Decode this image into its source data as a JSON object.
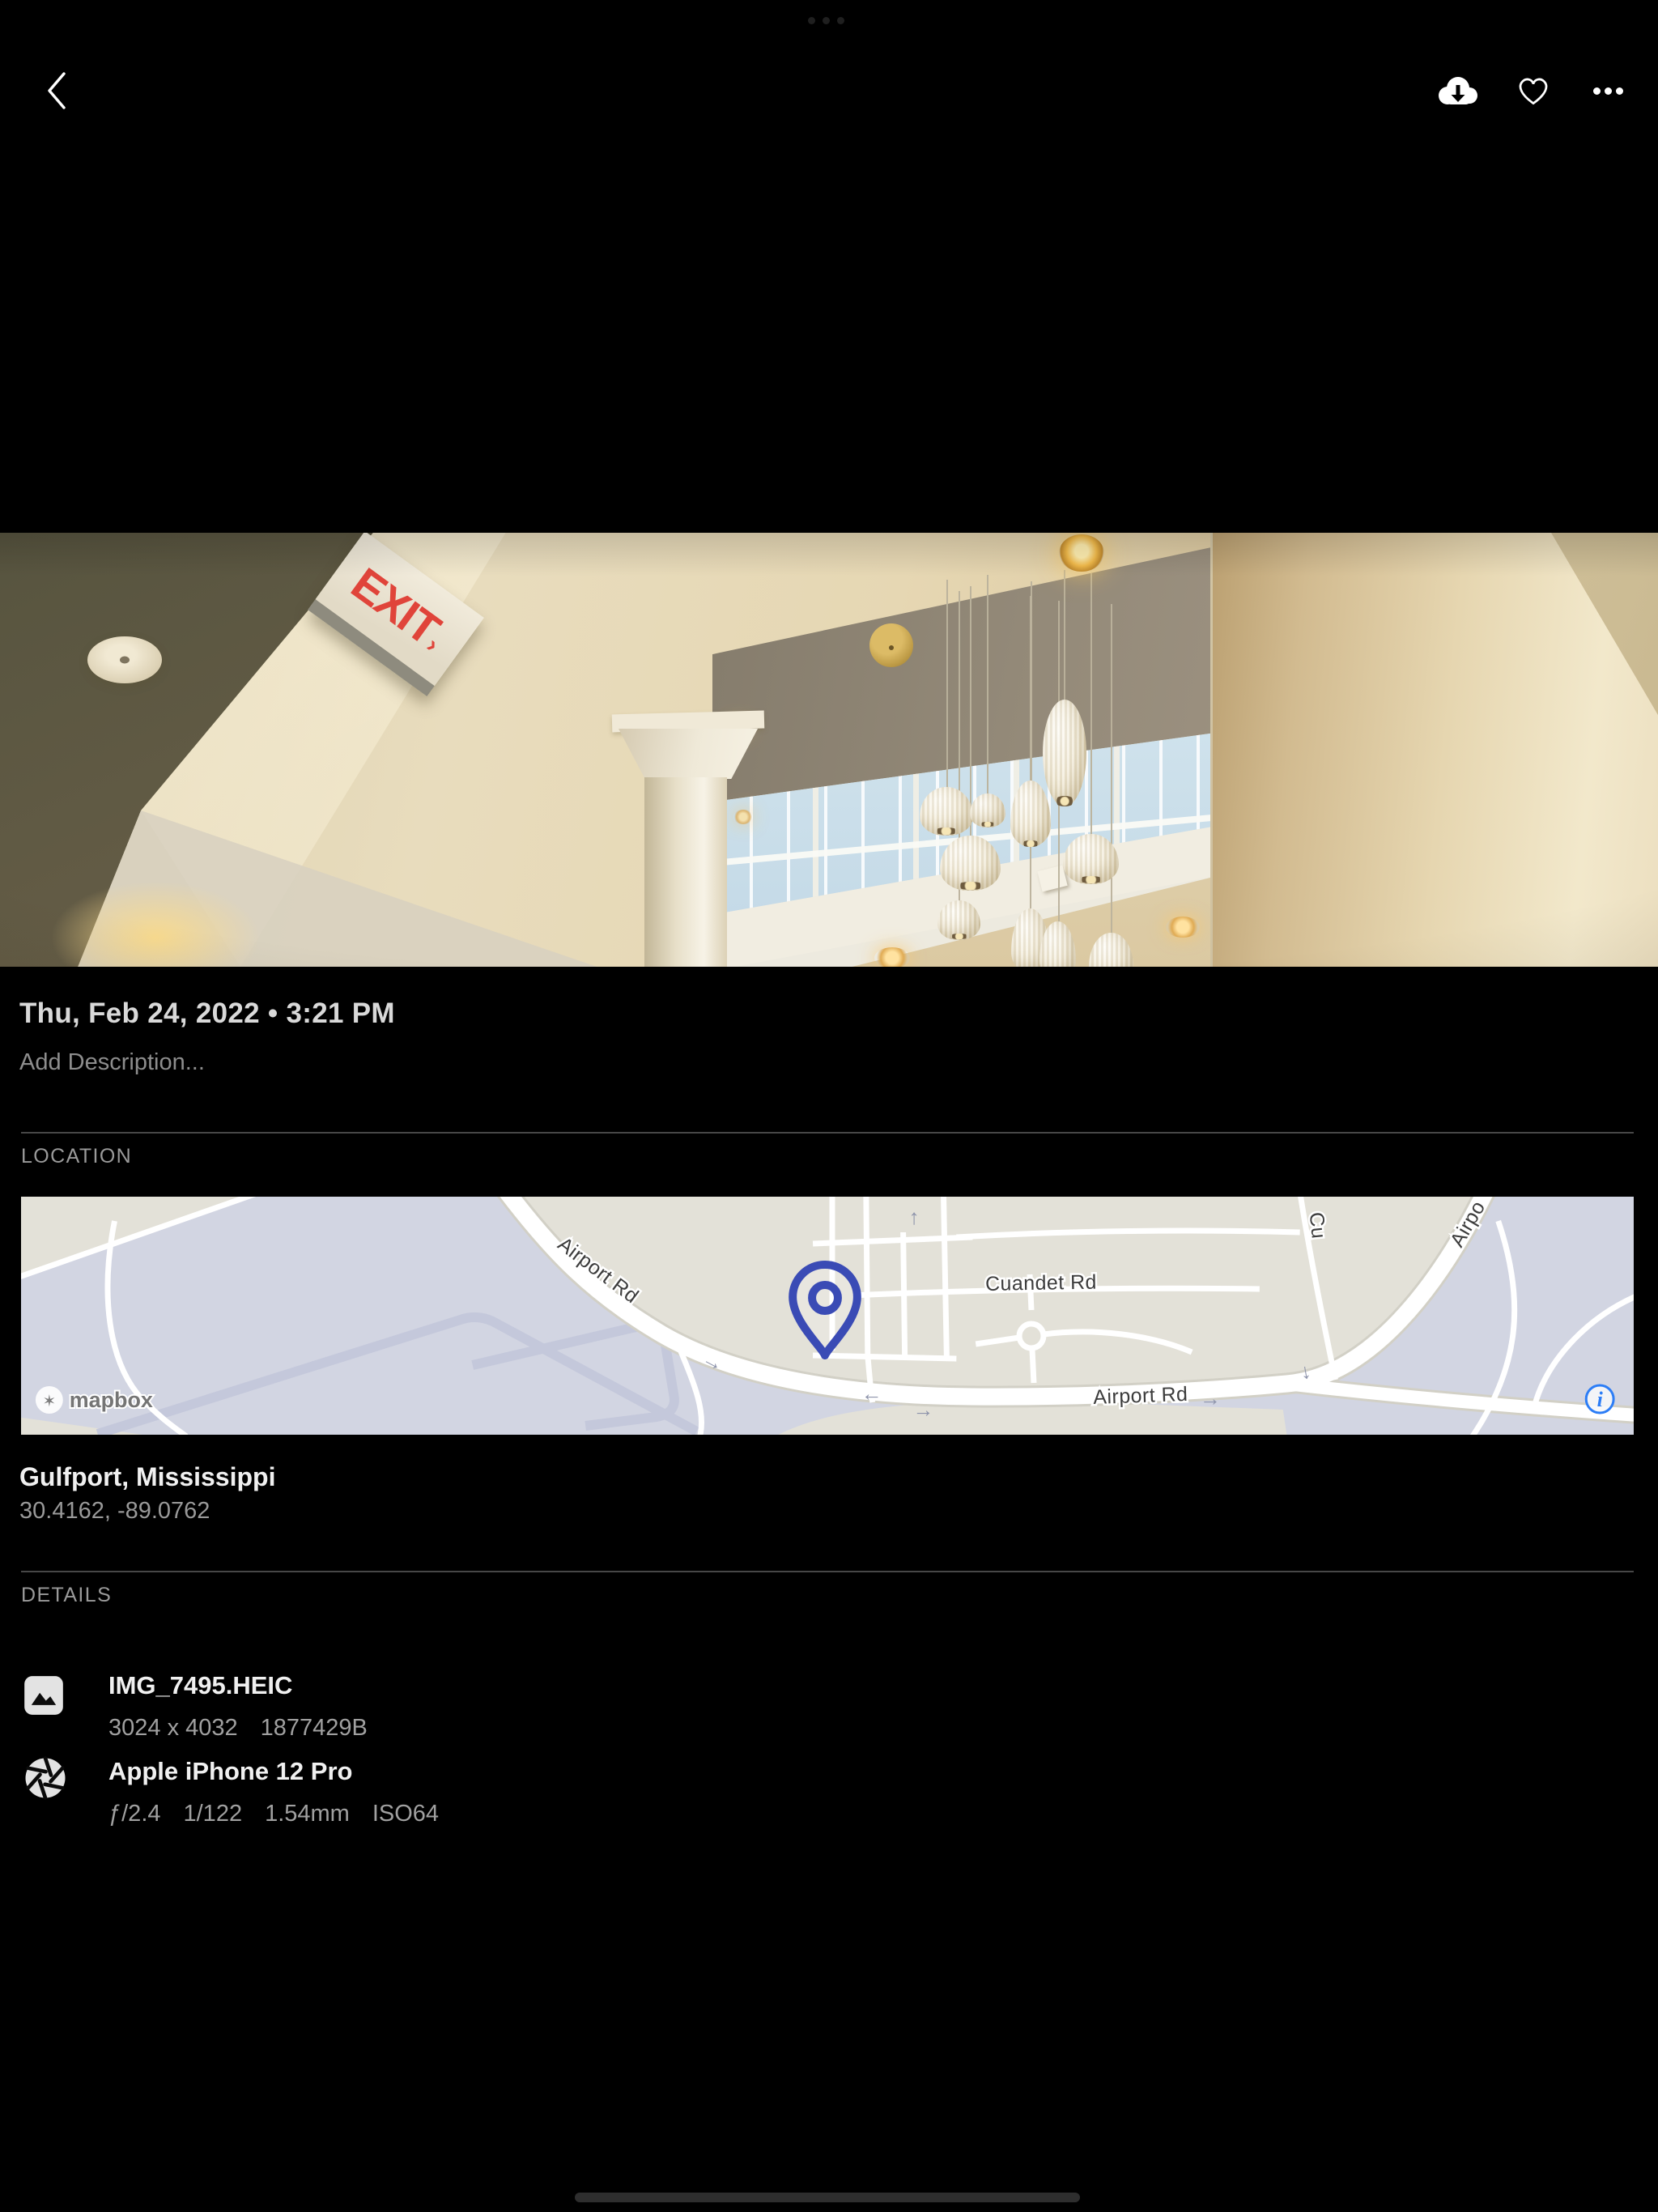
{
  "toolbar": {
    "icons": [
      {
        "name": "back-chevron"
      },
      {
        "name": "cloud-download"
      },
      {
        "name": "heart-outline"
      },
      {
        "name": "more-ellipsis"
      }
    ]
  },
  "photo": {
    "exit_sign": {
      "text": "EXIT",
      "arrow": "›"
    }
  },
  "meta": {
    "date": "Thu, Feb 24, 2022 • 3:21 PM",
    "description_placeholder": "Add Description..."
  },
  "location": {
    "label": "LOCATION",
    "place": "Gulfport, Mississippi",
    "coordinates": "30.4162, -89.0762",
    "map": {
      "labels": {
        "airport_rd_diagonal": "Airport Rd",
        "cuandet_rd": "Cuandet Rd",
        "airport_rd_horizontal": "Airport Rd",
        "airport_rd_upper_right": "Airpo",
        "cross_street_partial": "Cu"
      },
      "attribution": {
        "logo_text": "mapbox",
        "info_symbol": "i"
      },
      "colors": {
        "pin": "#3a4bb5",
        "info_icon": "#2c7df6",
        "land": "#e3e1d8",
        "field": "#d2d5e2",
        "road": "#ffffff"
      }
    }
  },
  "details": {
    "label": "DETAILS",
    "items": [
      {
        "icon": "image-file",
        "title": "IMG_7495.HEIC",
        "meta": [
          "3024 x 4032",
          "1877429B"
        ]
      },
      {
        "icon": "aperture-camera",
        "title": "Apple iPhone 12 Pro",
        "meta": [
          "ƒ/2.4",
          "1/122",
          "1.54mm",
          "ISO64"
        ]
      }
    ]
  }
}
